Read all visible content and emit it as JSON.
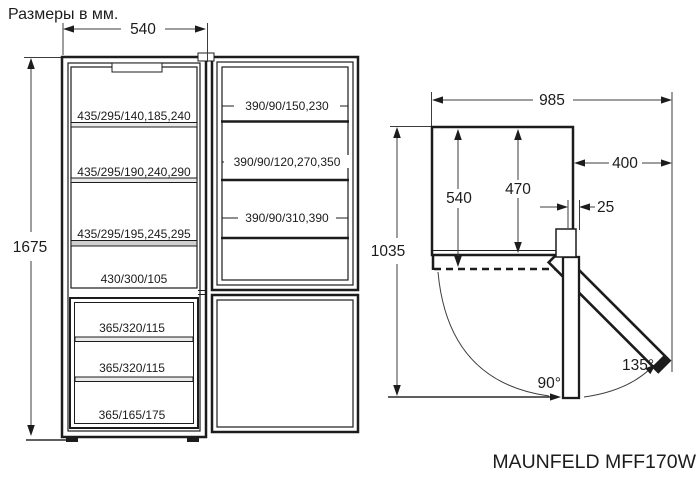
{
  "title": "Размеры в мм.",
  "model_label": "MAUNFELD MFF170W",
  "front_view": {
    "width_mm": "540",
    "height_mm": "1675",
    "fridge_shelves": [
      "435/295/140,185,240",
      "435/295/190,240,290",
      "435/295/195,245,295",
      "430/300/105"
    ],
    "freezer_drawers": [
      "365/320/115",
      "365/320/115",
      "365/165/175"
    ],
    "door_shelves": [
      "390/90/150,230",
      "390/90/120,270,350",
      "390/90/310,390"
    ]
  },
  "top_view": {
    "total_width_door_open_mm": "985",
    "door_projection_mm": "400",
    "cabinet_depth_mm": "540",
    "interior_depth_mm": "470",
    "total_depth_door_open_mm": "1035",
    "hinge_clearance_mm": "25",
    "door_angle_primary": "90°",
    "door_angle_max": "135°"
  },
  "colors": {
    "line": "#1c1c1c",
    "dim_line": "#3c3c3c",
    "background": "#ffffff"
  }
}
